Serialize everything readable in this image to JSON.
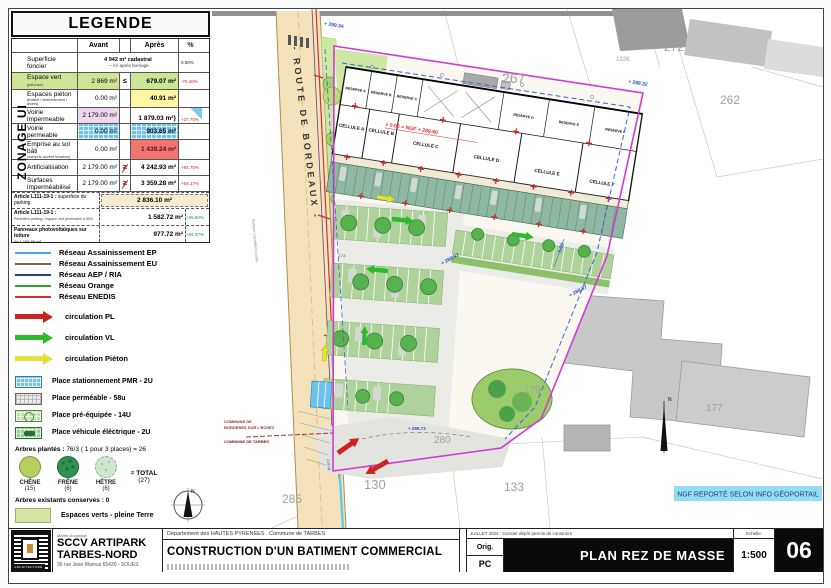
{
  "legend": {
    "title": "LEGENDE",
    "zonage": "ZONAGE UI",
    "table": {
      "col_avant": "Avant",
      "col_apres": "Après",
      "col_pct": "%",
      "r1_label": "Superficie foncier",
      "r1_value1": "4 942 m² cadastral",
      "r1_value2": "--- m² après bornage",
      "r1_pct": "0.00%",
      "r2_label": "Espace vert",
      "r2_sub": "(pelouse)",
      "r2_avant": "2 869 m²",
      "r2_sym": "≤",
      "r2_apres": "679.07 m²",
      "r2_pct": "-76.40%",
      "r3_label": "Espaces piéton",
      "r3_sub": "(trottoir / cheminement / divers)",
      "r3_avant": "0.00 m²",
      "r3_apres": "40.91 m²",
      "r4_label": "Voirie impermeable",
      "r4_avant": "2 179.00 m²",
      "r4_apres": "1 879.03 m²",
      "r4_brace": "}",
      "r45_pct": "+27.70%",
      "r5_label": "Voirie permeable",
      "r5_avant": "0.00 m²",
      "r5_apres": "903.65 m²",
      "r6_label": "Emprise au sol bâti",
      "r6_sub": "(compris auvent livraison)",
      "r6_avant": "0.00 m²",
      "r6_apres": "1 439.24 m²",
      "r7_label": "Artificialisation",
      "r7_avant": "2 179.00 m²",
      "r7_sym": "≥",
      "r7_apres": "4 242.93 m²",
      "r7_pct": "+94.70%",
      "r8_label": "Surfaces imperméabilisé",
      "r8_avant": "2 179.00 m²",
      "r8_sym": "≥",
      "r8_apres": "3 359.28 m²",
      "r8_pct": "+54.17%",
      "a1_label": "Article L111-19-1 :",
      "a1_sub": "superficie du parking",
      "a1_value": "2 836.10 m²",
      "a2_label": "Article L111-19-1 :",
      "a2_sub": "Périmètre parking / espace vert perméable à 50%",
      "a2_value": "1 582.72 m²",
      "a2_pct": "+55.80%",
      "a3_label": "Panneaux photovoltaïques sur toiture",
      "a3_sub": "de 1 158.86 m²",
      "a3_value": "977.72 m²",
      "a3_pct": "+84.37%"
    },
    "networks": [
      {
        "label": "Réseau Assainissement EP",
        "color": "#4da6e0"
      },
      {
        "label": "Réseau Assainissement EU",
        "color": "#8a6240"
      },
      {
        "label": "Réseau AEP / RIA",
        "color": "#1f3d99"
      },
      {
        "label": "Réseau Orange",
        "color": "#33a02c"
      },
      {
        "label": "Réseau ENEDIS",
        "color": "#cc3333"
      }
    ],
    "circulations": [
      {
        "label": "circulation PL",
        "color": "#cc2222"
      },
      {
        "label": "circulation VL",
        "color": "#2eb82e"
      },
      {
        "label": "circulation Piéton",
        "color": "#e3e03a"
      }
    ],
    "places": [
      {
        "label": "Place stationnement PMR - 2U",
        "color": "#6fc2ef"
      },
      {
        "label": "Place perméable - 58u",
        "color": "#ececec"
      },
      {
        "label": "Place pré-équipée - 14U",
        "color": "#b9e0a6"
      },
      {
        "label": "Place véhicule éléctrique - 2U",
        "color": "#8ed48e"
      }
    ],
    "arbres_plantes_label": "Arbres plantés :",
    "arbres_plantes_value": "76/3 ( 1 pour 3 places) = 26",
    "trees": [
      {
        "name": "CHÊNE",
        "count": "(15)"
      },
      {
        "name": "FRÊNE",
        "count": "(6)"
      },
      {
        "name": "HÊTRE",
        "count": "(6)"
      }
    ],
    "trees_total_label": "= TOTAL",
    "trees_total_count": "(27)",
    "arbres_existants": "Arbres existants conservés : 0",
    "espaces_verts_label": "Espaces verts - pleine Terre",
    "north_label": "N"
  },
  "plan": {
    "road_label": "- ROUTE DE BORDEAUX -",
    "road_side_note": "Surface circulation voirie",
    "road_side_note2": "2.50 ml",
    "parcels": {
      "p267": "267",
      "p272": "272",
      "p1326": "1326",
      "p262": "262",
      "p177": "177",
      "p179": "179",
      "p280": "280",
      "p130": "130",
      "p133": "133",
      "p285": "285"
    },
    "cells": [
      "CELLULE A",
      "CELLULE B",
      "CELLULE C",
      "CELLULE D",
      "CELLULE E",
      "CELLULE F"
    ],
    "reserves": [
      "RESERVE A",
      "RESERVE B",
      "RESERVE C",
      "RESERVE D",
      "RESERVE E",
      "RESERVE F"
    ],
    "level_note": "± 0.00 = NGF + 289.60",
    "elevations": {
      "e1": "+ 289.34",
      "e2": "+ 288.32",
      "e3": "+ 288.92",
      "e4": "+ 288.97",
      "e5": "+ 288.73"
    },
    "dim_5": "5.00",
    "count_174": "174",
    "commune_line1": "COMMUNE DE",
    "commune_line2": "BORDERES SUR L'ECHEZ",
    "commune_line3": "COMMUNE DE TARBES",
    "ngf_note": "NGF REPORTÉ SELON INFO GÉOPORTAIL",
    "north_label": "N"
  },
  "titleblock": {
    "logo_text": "ARCHITECTURE",
    "owner_label": "Maître d'ouvrage",
    "company1": "SCCV ARTIPARK",
    "company2": "TARBES-NORD",
    "address": "36 rue Jean Mamus  65430 - SOUES",
    "dept": "Département des HAUTES PYRENEES  . Commune de TARBES",
    "project": "CONSTRUCTION D'UN BATIMENT COMMERCIAL",
    "phase_date": "JUILLET 2024 : Dossier dépôt permis de construire",
    "orig": "Orig.",
    "pc": "PC",
    "sheet_title": "PLAN REZ DE MASSE",
    "scale_label": "Echelle:",
    "scale": "1:500",
    "number": "06"
  },
  "colors": {
    "boundary_magenta": "#cf3ccf",
    "setback_blue": "#3a62d8",
    "road_beige": "#f4e3ba",
    "verge_green": "#cfe7a4",
    "parking_permeable": "#aed29a",
    "parking_teal": "#8fb8a2",
    "existing_building_gray": "#c8c8c8",
    "ngf_note_bg": "#86d9f2",
    "marker_red": "#d22222",
    "elevation_blue": "#2b50c8"
  }
}
